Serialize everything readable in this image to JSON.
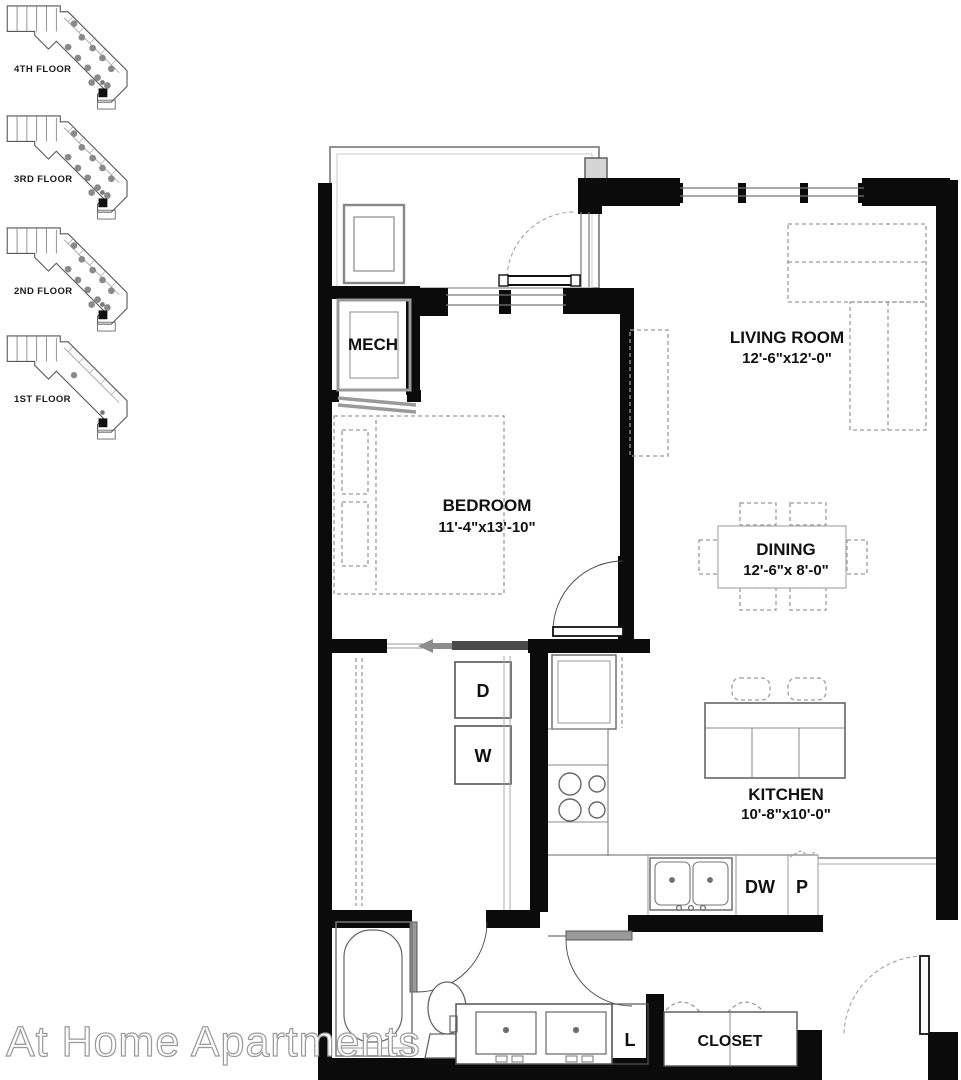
{
  "watermark": "At Home Apartments",
  "key_plans": [
    {
      "label": "4TH FLOOR"
    },
    {
      "label": "3RD FLOOR"
    },
    {
      "label": "2ND FLOOR"
    },
    {
      "label": "1ST FLOOR"
    }
  ],
  "rooms": {
    "living": {
      "name": "LIVING ROOM",
      "dims": "12'-6\"x12'-0\""
    },
    "bedroom": {
      "name": "BEDROOM",
      "dims": "11'-4\"x13'-10\""
    },
    "dining": {
      "name": "DINING",
      "dims": "12'-6\"x 8'-0\""
    },
    "kitchen": {
      "name": "KITCHEN",
      "dims": "10'-8\"x10'-0\""
    },
    "mech": {
      "name": "MECH"
    },
    "closet": {
      "name": "CLOSET"
    }
  },
  "appliances": {
    "dryer": "D",
    "washer": "W",
    "dishwasher": "DW",
    "pantry": "P",
    "linen": "L"
  },
  "colors": {
    "wall": "#0b0b0b",
    "fixture": "#666666",
    "furniture_dashed": "#9a9a9a",
    "unit_dot": "#8a8a8a"
  }
}
